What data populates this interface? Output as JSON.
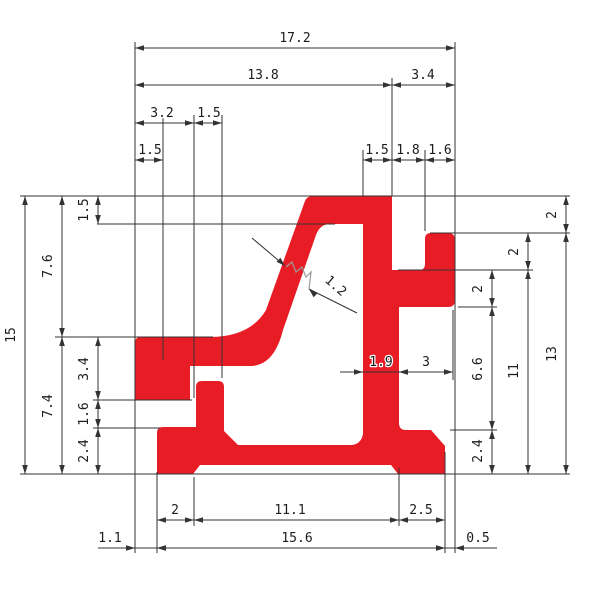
{
  "drawing": {
    "description": "Technical cross-section drawing of extrusion profile with dimensions",
    "profile_color": "#e81c24",
    "line_color": "#333333",
    "background": "#ffffff",
    "dims_horizontal": [
      {
        "v": "17.2",
        "y": 48,
        "x1": 135,
        "x2": 455,
        "lx": 295,
        "ly": 42
      },
      {
        "v": "13.8",
        "y": 85,
        "x1": 135,
        "x2": 392,
        "lx": 263,
        "ly": 79
      },
      {
        "v": "3.4",
        "y": 85,
        "x1": 392,
        "x2": 455,
        "lx": 423,
        "ly": 79
      },
      {
        "v": "3.2",
        "y": 123,
        "x1": 135,
        "x2": 194,
        "lx": 162,
        "ly": 117
      },
      {
        "v": "1.5",
        "y": 123,
        "x1": 194,
        "x2": 222,
        "lx": 209,
        "ly": 117
      },
      {
        "v": "1.5",
        "y": 160,
        "x1": 135,
        "x2": 163,
        "lx": 150,
        "ly": 154
      },
      {
        "v": "1.5",
        "y": 160,
        "x1": 363,
        "x2": 392,
        "lx": 377,
        "ly": 154
      },
      {
        "v": "1.8",
        "y": 160,
        "x1": 392,
        "x2": 425,
        "lx": 408,
        "ly": 154
      },
      {
        "v": "1.6",
        "y": 160,
        "x1": 425,
        "x2": 455,
        "lx": 440,
        "ly": 154
      },
      {
        "v": "1.9",
        "y": 372,
        "x1": 363,
        "x2": 399,
        "lx": 381,
        "ly": 366,
        "out": true,
        "tl": 23,
        "tr": 16
      },
      {
        "v": "3",
        "y": 372,
        "x1": 399,
        "x2": 453,
        "lx": 426,
        "ly": 366
      },
      {
        "v": "2",
        "y": 520,
        "x1": 157,
        "x2": 194,
        "lx": 175,
        "ly": 514
      },
      {
        "v": "11.1",
        "y": 520,
        "x1": 194,
        "x2": 399,
        "lx": 290,
        "ly": 514
      },
      {
        "v": "2.5",
        "y": 520,
        "x1": 399,
        "x2": 445,
        "lx": 421,
        "ly": 514
      },
      {
        "v": "1.1",
        "y": 548,
        "x1": 135,
        "x2": 157,
        "lx": 110,
        "ly": 542,
        "out": true,
        "tl": 37,
        "tr": 2
      },
      {
        "v": "15.6",
        "y": 548,
        "x1": 157,
        "x2": 445,
        "lx": 297,
        "ly": 542
      },
      {
        "v": "0.5",
        "y": 548,
        "x1": 445,
        "x2": 455,
        "lx": 478,
        "ly": 542,
        "out": true,
        "tl": 2,
        "tr": 42
      }
    ],
    "dims_vertical": [
      {
        "v": "15",
        "x": 25,
        "y1": 196,
        "y2": 474,
        "lx": 15,
        "ly": 335
      },
      {
        "v": "7.6",
        "x": 62,
        "y1": 196,
        "y2": 337,
        "lx": 52,
        "ly": 266
      },
      {
        "v": "7.4",
        "x": 62,
        "y1": 337,
        "y2": 474,
        "lx": 52,
        "ly": 406
      },
      {
        "v": "1.5",
        "x": 98,
        "y1": 196,
        "y2": 224,
        "lx": 88,
        "ly": 210
      },
      {
        "v": "3.4",
        "x": 98,
        "y1": 337,
        "y2": 400,
        "lx": 88,
        "ly": 369
      },
      {
        "v": "1.6",
        "x": 98,
        "y1": 400,
        "y2": 428,
        "lx": 88,
        "ly": 414
      },
      {
        "v": "2.4",
        "x": 98,
        "y1": 428,
        "y2": 474,
        "lx": 88,
        "ly": 451
      },
      {
        "v": "2",
        "x": 566,
        "y1": 196,
        "y2": 233,
        "lx": 556,
        "ly": 215
      },
      {
        "v": "13",
        "x": 566,
        "y1": 233,
        "y2": 474,
        "lx": 556,
        "ly": 354
      },
      {
        "v": "2",
        "x": 528,
        "y1": 233,
        "y2": 270,
        "lx": 518,
        "ly": 252
      },
      {
        "v": "11",
        "x": 528,
        "y1": 270,
        "y2": 474,
        "lx": 518,
        "ly": 371
      },
      {
        "v": "2",
        "x": 492,
        "y1": 270,
        "y2": 307,
        "lx": 482,
        "ly": 289
      },
      {
        "v": "6.6",
        "x": 492,
        "y1": 307,
        "y2": 430,
        "lx": 482,
        "ly": 369
      },
      {
        "v": "2.4",
        "x": 492,
        "y1": 430,
        "y2": 474,
        "lx": 482,
        "ly": 451
      }
    ],
    "dim_diagonal": {
      "v": "1.2",
      "tip1": [
        285,
        266
      ],
      "tip2": [
        309,
        289
      ],
      "tail1": [
        252,
        238
      ],
      "tail2": [
        357,
        313
      ],
      "label": [
        333,
        289
      ],
      "angle": 41
    },
    "ext_vertical": [
      [
        135,
        42,
        553
      ],
      [
        163,
        115,
        360
      ],
      [
        194,
        115,
        398
      ],
      [
        222,
        115,
        378
      ],
      [
        363,
        150,
        196
      ],
      [
        392,
        78,
        196
      ],
      [
        425,
        150,
        231
      ],
      [
        455,
        42,
        553
      ],
      [
        157,
        472,
        553
      ],
      [
        194,
        477,
        526
      ],
      [
        399,
        468,
        526
      ],
      [
        445,
        452,
        553
      ],
      [
        453,
        310,
        380
      ]
    ],
    "ext_horizontal": [
      [
        196,
        20,
        570
      ],
      [
        224,
        97,
        335
      ],
      [
        233,
        430,
        570
      ],
      [
        270,
        398,
        533
      ],
      [
        307,
        458,
        497
      ],
      [
        337,
        55,
        213
      ],
      [
        400,
        93,
        192
      ],
      [
        428,
        93,
        160
      ],
      [
        430,
        450,
        497
      ],
      [
        474,
        20,
        570
      ]
    ]
  }
}
